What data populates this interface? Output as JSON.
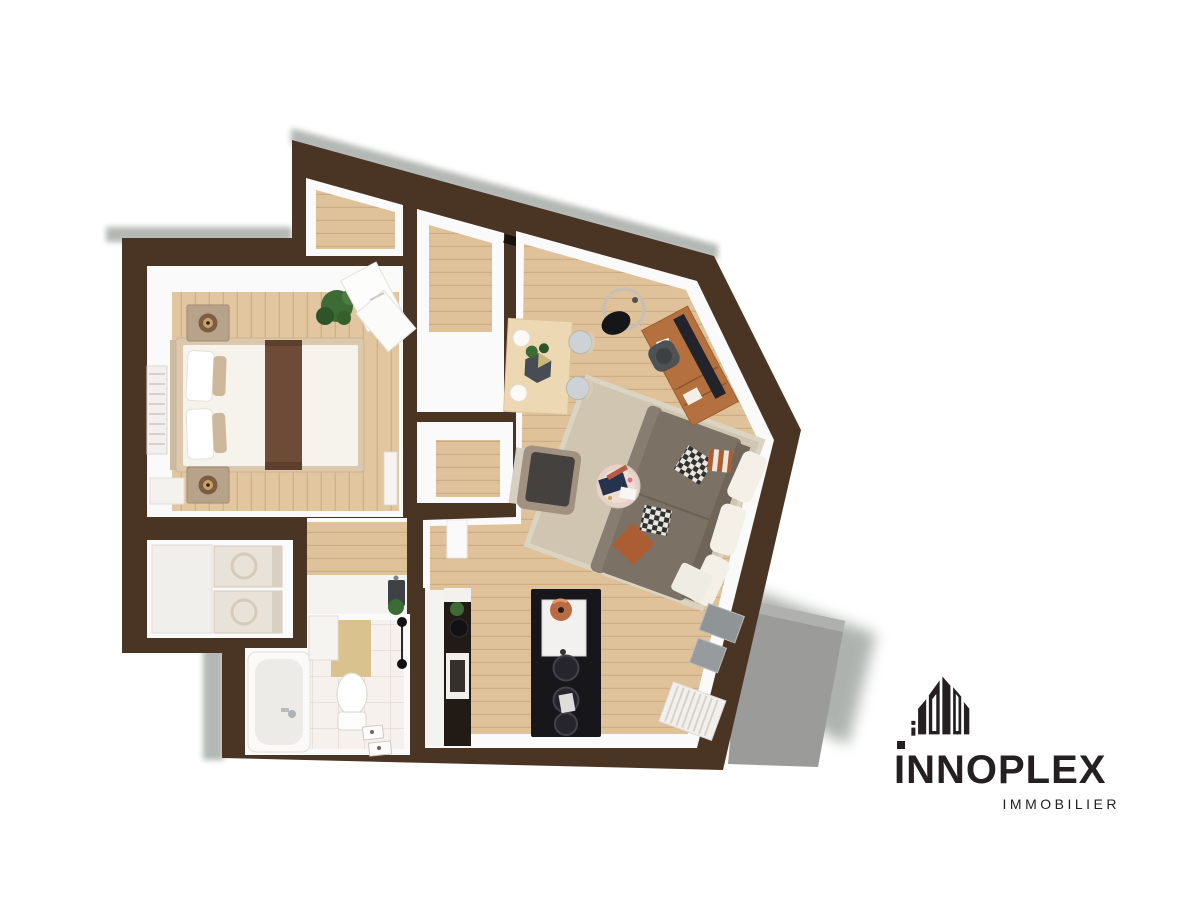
{
  "meta": {
    "type": "3d-floorplan-top-view-render",
    "background": "white"
  },
  "logo": {
    "name": "INNOPLEX",
    "subtitle": "IMMOBILIER",
    "icon": "skyline-buildings-icon"
  },
  "palette": {
    "background": "#ffffff",
    "wall": "#4a3424",
    "shadow": "#9aa09b",
    "cavity": "#fbfafa",
    "wood": "#e2c69f",
    "wood_living": "#dfc29a",
    "wood_line": "rgba(146,100,55,0.22)",
    "tile": "#f6f1ed",
    "rug": "#cfc5b1",
    "sofa": "#7b7265",
    "sofa_arm": "#877e71",
    "cushion_white": "#f4f0e8",
    "pillow_orange": "#ad5d33",
    "runner_brown": "#6d4b37",
    "mattress": "#f6f3ec",
    "bed_frame": "#dcc9ad",
    "nightstand": "#b7a28a",
    "desk": "#b4703e",
    "monitor": "#23232b",
    "table": "#ecd8b2",
    "island": "#17161b",
    "copper": "#b96b43",
    "terrace": "#9b9b99",
    "glass": "#8f9497",
    "plant": "#3c6b35",
    "radiator": "#f2f0ec",
    "logo_ink": "#242021"
  },
  "scene": {
    "rooms": [
      {
        "id": "bedroom",
        "furniture": [
          "double-bed",
          "two-nightstands-with-lamps",
          "radiator",
          "potted-plant",
          "magazines-on-floor",
          "open-door"
        ]
      },
      {
        "id": "entry-closets",
        "furniture": [
          "wardrobe",
          "dressing-closet",
          "hall-closet"
        ]
      },
      {
        "id": "utility-room",
        "furniture": [
          "tall-cabinet",
          "stacked-washer-dryer"
        ]
      },
      {
        "id": "bathroom",
        "furniture": [
          "bathtub",
          "toilet",
          "bath-mat",
          "vanity",
          "towel-hooks",
          "floor-drains",
          "small-plant"
        ]
      },
      {
        "id": "kitchen",
        "furniture": [
          "counter-with-sink",
          "tall-dark-unit",
          "black-island-with-sink",
          "three-bar-stools",
          "copper-pendant-lamp"
        ]
      },
      {
        "id": "living-dining",
        "furniture": [
          "dining-table-with-plant",
          "two-chairs",
          "arc-floor-lamp",
          "desk-with-monitor",
          "office-chair",
          "sectional-sofa",
          "area-rug",
          "round-coffee-table",
          "armchair",
          "radiator",
          "glass-door"
        ]
      },
      {
        "id": "terrace",
        "furniture": []
      }
    ]
  }
}
